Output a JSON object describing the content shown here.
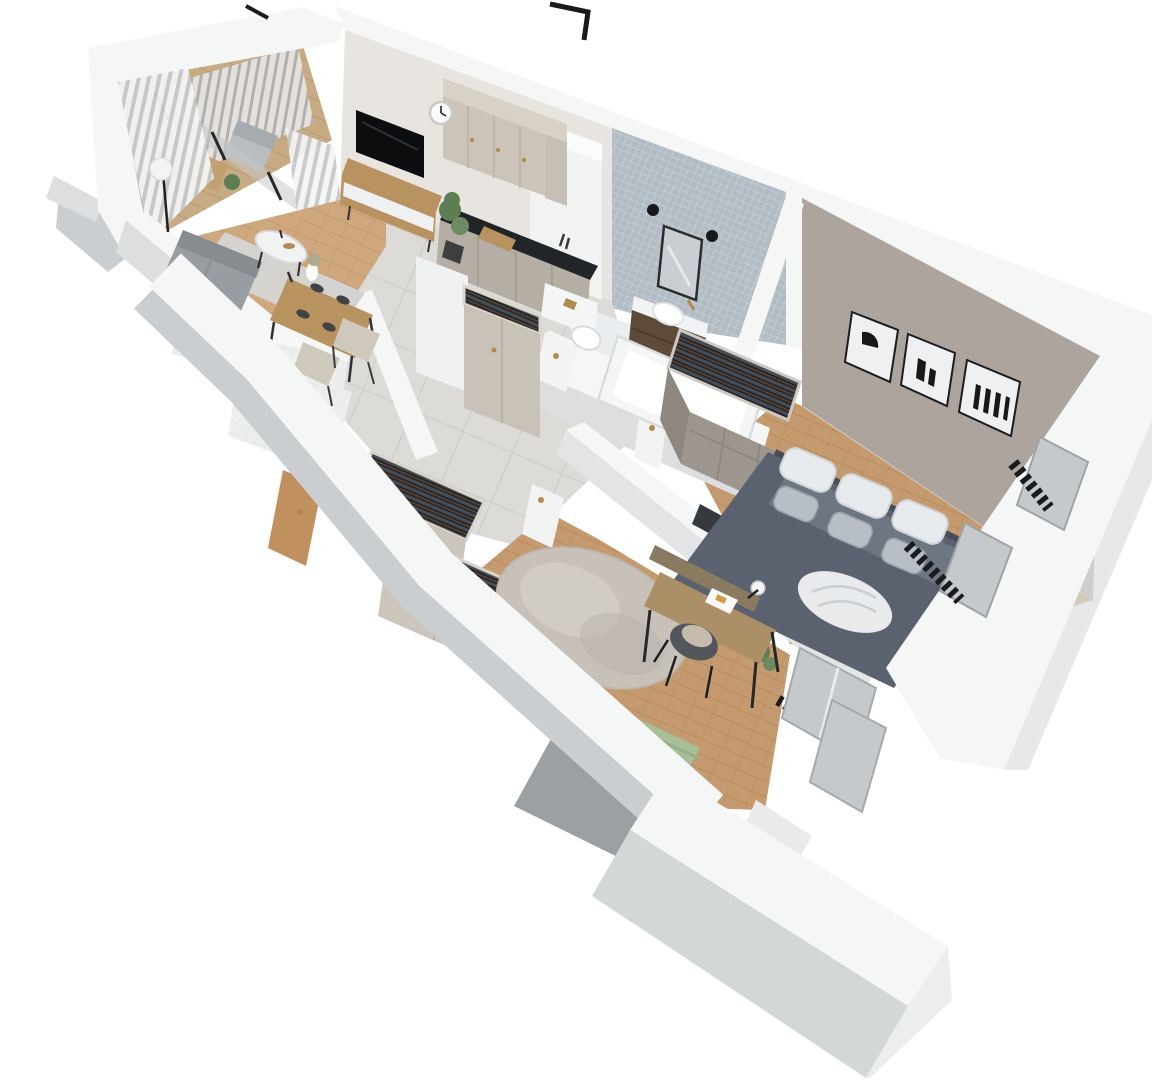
{
  "scene": {
    "title": "3D isometric cutaway render of a one-bedroom apartment floor plan",
    "style": "top-down axonometric dollhouse view, white cut walls, no text labels",
    "background": "#ffffff"
  },
  "palette": {
    "wallTop": "#f5f6f6",
    "wallFace": "#dcdedf",
    "wallFaceDark": "#cbced0",
    "wallWarm": "#e8e4df",
    "bedroomWall": "#aca49d",
    "mosaic": "#b2bcc4",
    "wood1": "#cfa87d",
    "wood2": "#bc9469",
    "woodBed1": "#c49a6e",
    "woodBed2": "#b08655",
    "tile1": "#dcdbd8",
    "tileLine": "#c6c5c1",
    "marble": "#eaedef",
    "beigeCab": "#ccc4b8",
    "cornice": "#d7d1c6",
    "lowerCab": "#b4aea5",
    "counterBlack": "#222528",
    "woodFurn": "#b9935f",
    "sofa": "#989da1",
    "rugLiving": "#d4d3d0",
    "rugRound": "#c7c1b9",
    "duvet": "#59626e",
    "duvetLight": "#7e8893",
    "pillowWhite": "#e8ebee",
    "pillowGray": "#b7bec6",
    "green": "#a6bf98",
    "clothesDark": "#24272c",
    "clothesLight": "#474d55",
    "brass": "#b08a4f",
    "doorWood": "#c0905f",
    "radiator": "#1a1b1d",
    "glass": "#c5c9cb",
    "artBlack": "#17181a",
    "plant": "#5e7d52",
    "wcTile": "#edefef"
  },
  "rooms": [
    {
      "id": "balcony",
      "label": "Balcony with railing, lounge chair, side table and plant"
    },
    {
      "id": "living-room",
      "label": "Living room with TV, media console, sofa, rug, coffee table, floor lamp and curtains"
    },
    {
      "id": "dining-area",
      "label": "Dining area with wooden table, place settings, vase and two chairs"
    },
    {
      "id": "kitchen",
      "label": "Kitchen with beige upper cabinets, black stone countertop and gray base cabinets"
    },
    {
      "id": "hallway",
      "label": "Tiled hallway with freestanding wardrobe cabinets full of hanging clothes"
    },
    {
      "id": "wc",
      "label": "Small WC with toilet, washbasin and wooden door"
    },
    {
      "id": "bathroom",
      "label": "Bathroom with mosaic tiled wall, mirror, sconces, vanity with vessel sink, wall-hung toilet and bathtub"
    },
    {
      "id": "bedroom",
      "label": "Bedroom with double bed, gray duvet, pillows, three framed prints, open wardrobe, TV panel and window radiators"
    },
    {
      "id": "second-room",
      "label": "Second room with round rug, desk, chair, lamp, single bed with green blanket, wardrobes and window radiator"
    }
  ],
  "objects": {
    "living": [
      "wall-mounted TV",
      "wood media console",
      "wall clock",
      "gray corner sofa",
      "round coffee table",
      "floor lamp",
      "striped curtains",
      "area rug",
      "potted plant"
    ],
    "kitchen": [
      "upper cabinets",
      "black countertop with cutting board",
      "base cabinets",
      "counter plant"
    ],
    "bathroom": [
      "framed mirror",
      "two black sconces",
      "dark wood vanity",
      "vessel sink",
      "wall-hung toilet with brass flush plate",
      "bathtub"
    ],
    "bedroom": [
      "double bed",
      "six pillows",
      "white throw blanket",
      "three abstract art frames",
      "open wardrobe with clothes",
      "black TV panel on half wall",
      "two black radiators",
      "windows",
      "floor plant"
    ],
    "second_room": [
      "round speckled rug",
      "desk with papers and ball lamp",
      "upholstered desk chair",
      "single bed with green blanket",
      "two open wardrobes with clothes",
      "black radiator",
      "window"
    ],
    "wc": [
      "toilet",
      "washbasin",
      "toilet-paper holder",
      "open wooden door"
    ],
    "roof": [
      "two black antenna fittings on wall tops"
    ]
  }
}
